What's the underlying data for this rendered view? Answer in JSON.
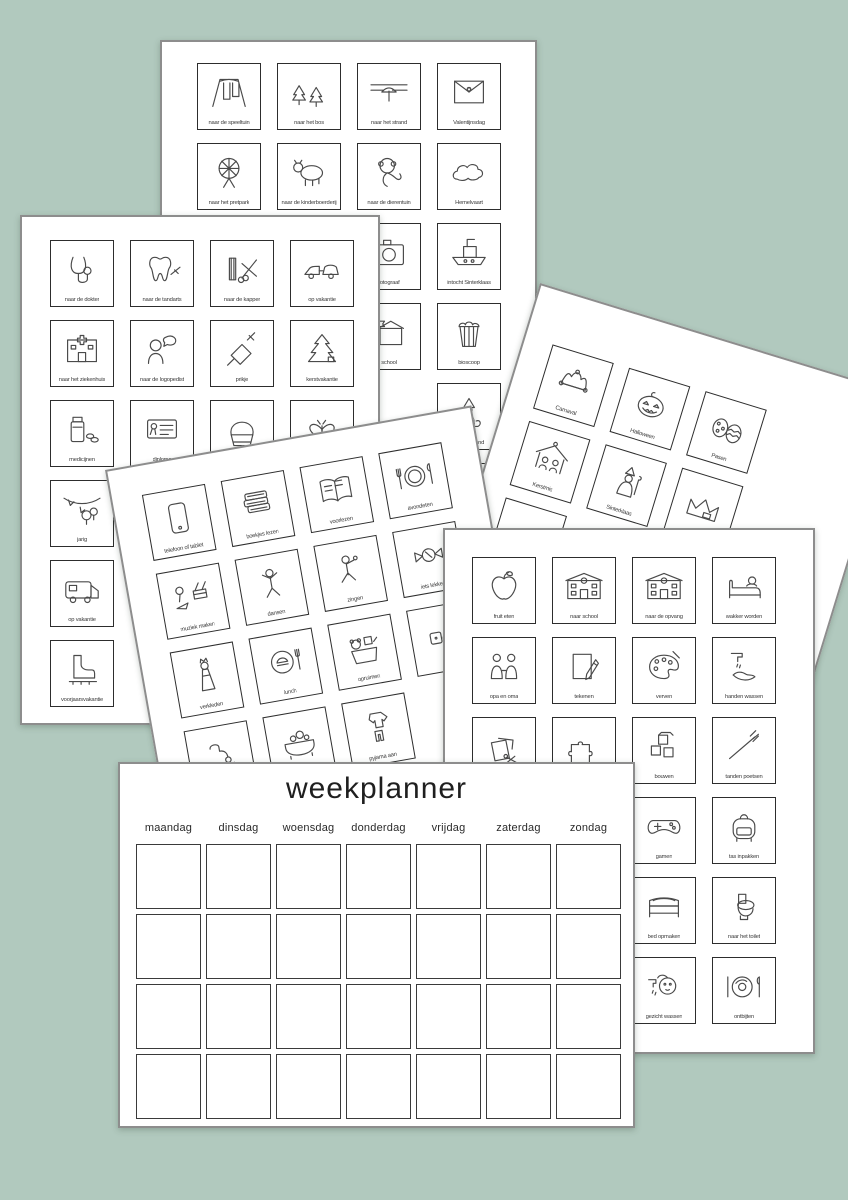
{
  "canvas": {
    "background_color": "#b1c9be",
    "sheet_border_color": "#8d8d8d",
    "card_border_color": "#2d2d2d"
  },
  "weekplanner": {
    "title": "weekplanner",
    "days": [
      "maandag",
      "dinsdag",
      "woensdag",
      "donderdag",
      "vrijdag",
      "zaterdag",
      "zondag"
    ],
    "grid_rows": 4,
    "grid_cols": 7
  },
  "sheets": {
    "outings": {
      "name": "outings-and-events-sheet",
      "cards": [
        {
          "icon": "swing",
          "label": "naar de speeltuin"
        },
        {
          "icon": "trees",
          "label": "naar het bos"
        },
        {
          "icon": "beach",
          "label": "naar het strand"
        },
        {
          "icon": "loveletter",
          "label": "Valentijnsdag"
        },
        {
          "icon": "ferris",
          "label": "naar het pretpark"
        },
        {
          "icon": "cow",
          "label": "naar de kinderboerderij"
        },
        {
          "icon": "monkey",
          "label": "naar de dierentuin"
        },
        {
          "icon": "cloud",
          "label": "Hemelvaart"
        },
        {
          "icon": "blank",
          "label": ""
        },
        {
          "icon": "blank",
          "label": ""
        },
        {
          "icon": "camera",
          "label": "fotograaf"
        },
        {
          "icon": "boat",
          "label": "intocht Sinterklaas"
        },
        {
          "icon": "blank",
          "label": ""
        },
        {
          "icon": "blank",
          "label": ""
        },
        {
          "icon": "schoolflag",
          "label": "school"
        },
        {
          "icon": "popcorn",
          "label": "bioscoop"
        },
        {
          "icon": "blank",
          "label": ""
        },
        {
          "icon": "blank",
          "label": ""
        },
        {
          "icon": "blank",
          "label": ""
        },
        {
          "icon": "sint",
          "label": "pakjesavond"
        },
        {
          "icon": "blank",
          "label": ""
        },
        {
          "icon": "blank",
          "label": ""
        },
        {
          "icon": "blank",
          "label": ""
        },
        {
          "icon": "bus",
          "label": ""
        }
      ]
    },
    "health": {
      "name": "health-and-vacation-sheet",
      "cards": [
        {
          "icon": "stethoscope",
          "label": "naar de dokter"
        },
        {
          "icon": "tooth",
          "label": "naar de tandarts"
        },
        {
          "icon": "combscissors",
          "label": "naar de kapper"
        },
        {
          "icon": "carcaravan",
          "label": "op vakantie"
        },
        {
          "icon": "hospital",
          "label": "naar het ziekenhuis"
        },
        {
          "icon": "speech",
          "label": "naar de logopedist"
        },
        {
          "icon": "syringe",
          "label": "prikje"
        },
        {
          "icon": "xmastree",
          "label": "kerstvakantie"
        },
        {
          "icon": "medicine",
          "label": "medicijnen"
        },
        {
          "icon": "diploma",
          "label": "diploma"
        },
        {
          "icon": "cupcake",
          "label": ""
        },
        {
          "icon": "butterfly",
          "label": ""
        },
        {
          "icon": "party",
          "label": "jarig"
        },
        {
          "icon": "blank",
          "label": ""
        },
        {
          "icon": "blank",
          "label": ""
        },
        {
          "icon": "blank",
          "label": ""
        },
        {
          "icon": "camper",
          "label": "op vakantie"
        },
        {
          "icon": "blank",
          "label": ""
        },
        {
          "icon": "blank",
          "label": ""
        },
        {
          "icon": "blank",
          "label": ""
        },
        {
          "icon": "skate",
          "label": "voorjaarsvakantie"
        },
        {
          "icon": "blank",
          "label": ""
        },
        {
          "icon": "blank",
          "label": ""
        },
        {
          "icon": "blank",
          "label": ""
        }
      ]
    },
    "celebrations": {
      "name": "holidays-sheet",
      "cards": [
        {
          "icon": "jester",
          "label": "Carnaval"
        },
        {
          "icon": "pumpkin",
          "label": "Halloween"
        },
        {
          "icon": "eggs",
          "label": "Pasen"
        },
        {
          "icon": "blank",
          "label": ""
        },
        {
          "icon": "nativity",
          "label": "Kerstmis"
        },
        {
          "icon": "sint2",
          "label": "Sinterklaas"
        },
        {
          "icon": "crown",
          "label": ""
        },
        {
          "icon": "blank",
          "label": ""
        },
        {
          "icon": "gift",
          "label": ""
        },
        {
          "icon": "blank",
          "label": ""
        },
        {
          "icon": "blank",
          "label": ""
        },
        {
          "icon": "blank",
          "label": ""
        }
      ]
    },
    "evening": {
      "name": "home-activities-sheet",
      "cards": [
        {
          "icon": "phone",
          "label": "telefoon of tablet"
        },
        {
          "icon": "books",
          "label": "boekjes lezen"
        },
        {
          "icon": "openbook",
          "label": "voorlezen"
        },
        {
          "icon": "dinner",
          "label": "avondeten"
        },
        {
          "icon": "music",
          "label": "muziek maken"
        },
        {
          "icon": "dancer",
          "label": "dansen"
        },
        {
          "icon": "singer",
          "label": "zingen"
        },
        {
          "icon": "candy",
          "label": "iets lekkers"
        },
        {
          "icon": "dressup",
          "label": "verkleden"
        },
        {
          "icon": "lunch",
          "label": "lunch"
        },
        {
          "icon": "toybox",
          "label": "opruimen"
        },
        {
          "icon": "dice",
          "label": ""
        },
        {
          "icon": "shower",
          "label": ""
        },
        {
          "icon": "bath",
          "label": "in bad"
        },
        {
          "icon": "pyjama",
          "label": "pyjama aan"
        },
        {
          "icon": "blank",
          "label": ""
        }
      ]
    },
    "school": {
      "name": "school-day-sheet",
      "cards": [
        {
          "icon": "apple",
          "label": "fruit eten"
        },
        {
          "icon": "school",
          "label": "naar school"
        },
        {
          "icon": "building",
          "label": "naar de opvang"
        },
        {
          "icon": "bedwake",
          "label": "wakker worden"
        },
        {
          "icon": "grandparents",
          "label": "opa en oma"
        },
        {
          "icon": "paperpencil",
          "label": "tekenen"
        },
        {
          "icon": "palette",
          "label": "verven"
        },
        {
          "icon": "handwash",
          "label": "handen wassen"
        },
        {
          "icon": "paperscissors",
          "label": ""
        },
        {
          "icon": "puzzle",
          "label": ""
        },
        {
          "icon": "blocks",
          "label": "bouwen"
        },
        {
          "icon": "toothbrush",
          "label": "tanden poetsen"
        },
        {
          "icon": "blank",
          "label": ""
        },
        {
          "icon": "blank",
          "label": ""
        },
        {
          "icon": "controller",
          "label": "gamen"
        },
        {
          "icon": "backpack",
          "label": "tas inpakken"
        },
        {
          "icon": "blank",
          "label": ""
        },
        {
          "icon": "blank",
          "label": ""
        },
        {
          "icon": "bed",
          "label": "bed opmaken"
        },
        {
          "icon": "toilet",
          "label": "naar het toilet"
        },
        {
          "icon": "blank",
          "label": ""
        },
        {
          "icon": "blank",
          "label": ""
        },
        {
          "icon": "facewash",
          "label": "gezicht wassen"
        },
        {
          "icon": "breakfast",
          "label": "ontbijten"
        }
      ]
    }
  }
}
